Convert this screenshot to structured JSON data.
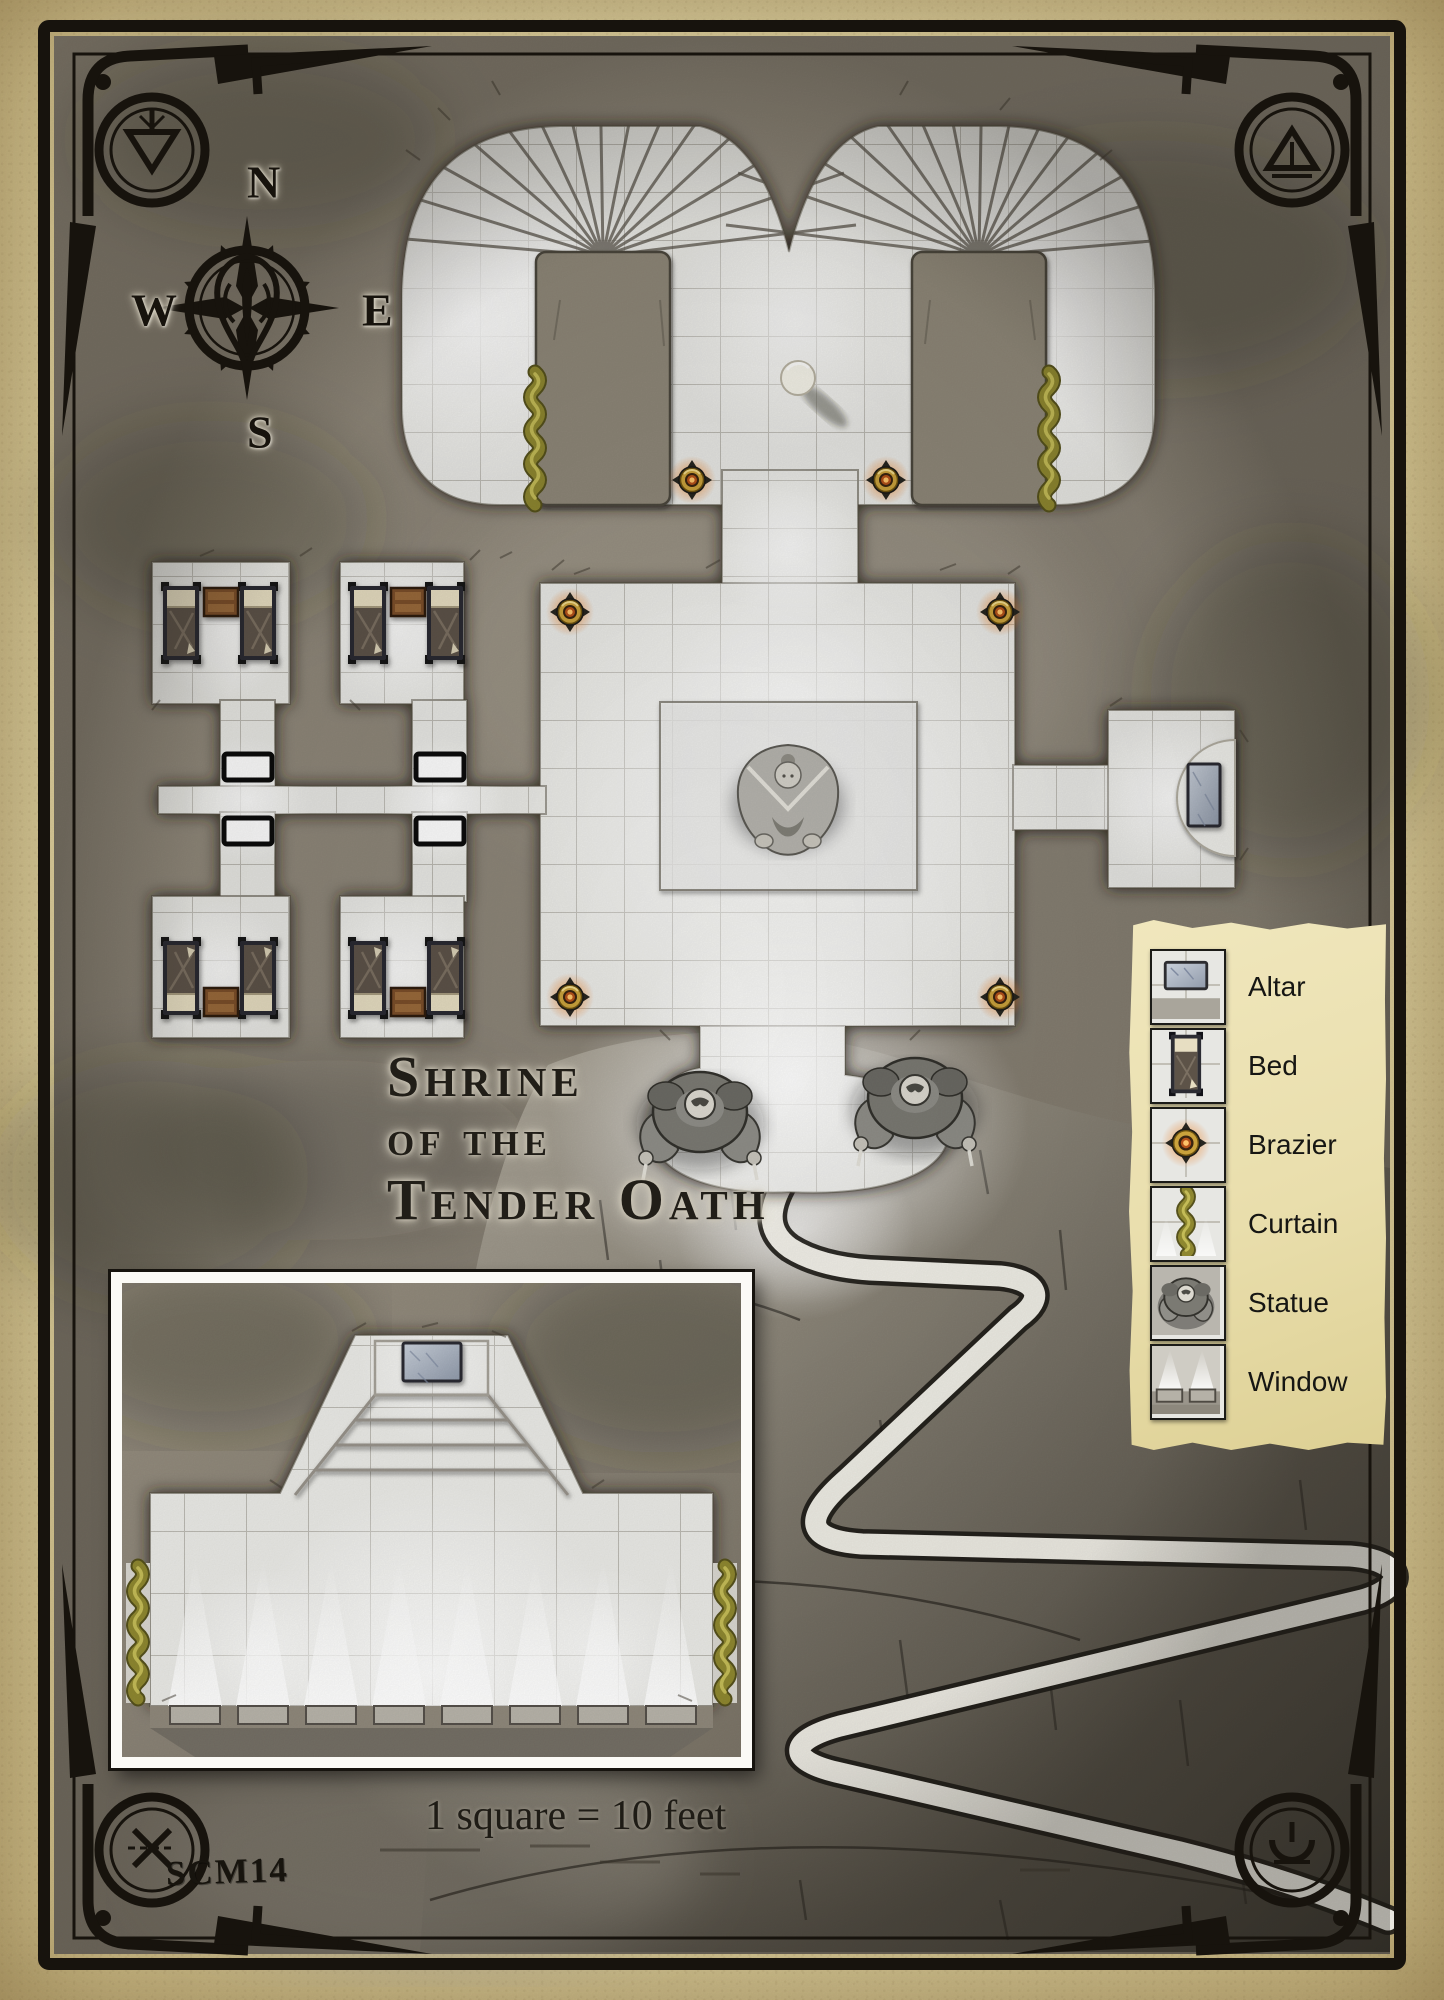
{
  "map": {
    "title_lines": [
      "Shrine",
      "of the",
      "Tender Oath"
    ],
    "code": "SCM14",
    "scale_note": "1 square = 10 feet"
  },
  "compass": {
    "north": "N",
    "east": "E",
    "south": "S",
    "west": "W"
  },
  "legend": {
    "items": [
      {
        "label": "Altar",
        "icon": "altar-icon"
      },
      {
        "label": "Bed",
        "icon": "bed-icon"
      },
      {
        "label": "Brazier",
        "icon": "brazier-icon"
      },
      {
        "label": "Curtain",
        "icon": "curtain-icon"
      },
      {
        "label": "Statue",
        "icon": "statue-icon"
      },
      {
        "label": "Window",
        "icon": "window-icon"
      }
    ]
  },
  "colors": {
    "parchment": "#e6daa8",
    "legend_parchment": "#ece2b4",
    "stone": "#8a8376",
    "floor": "#e9e9e5",
    "ink": "#17130d",
    "brazier_gold": "#caa23c",
    "brazier_fire": "#e2701c",
    "curtain_olive": "#8e8730",
    "altar_marble": "#aab3c1",
    "wood_brown": "#7b4f2b",
    "trail_white": "#f4f2ea"
  }
}
